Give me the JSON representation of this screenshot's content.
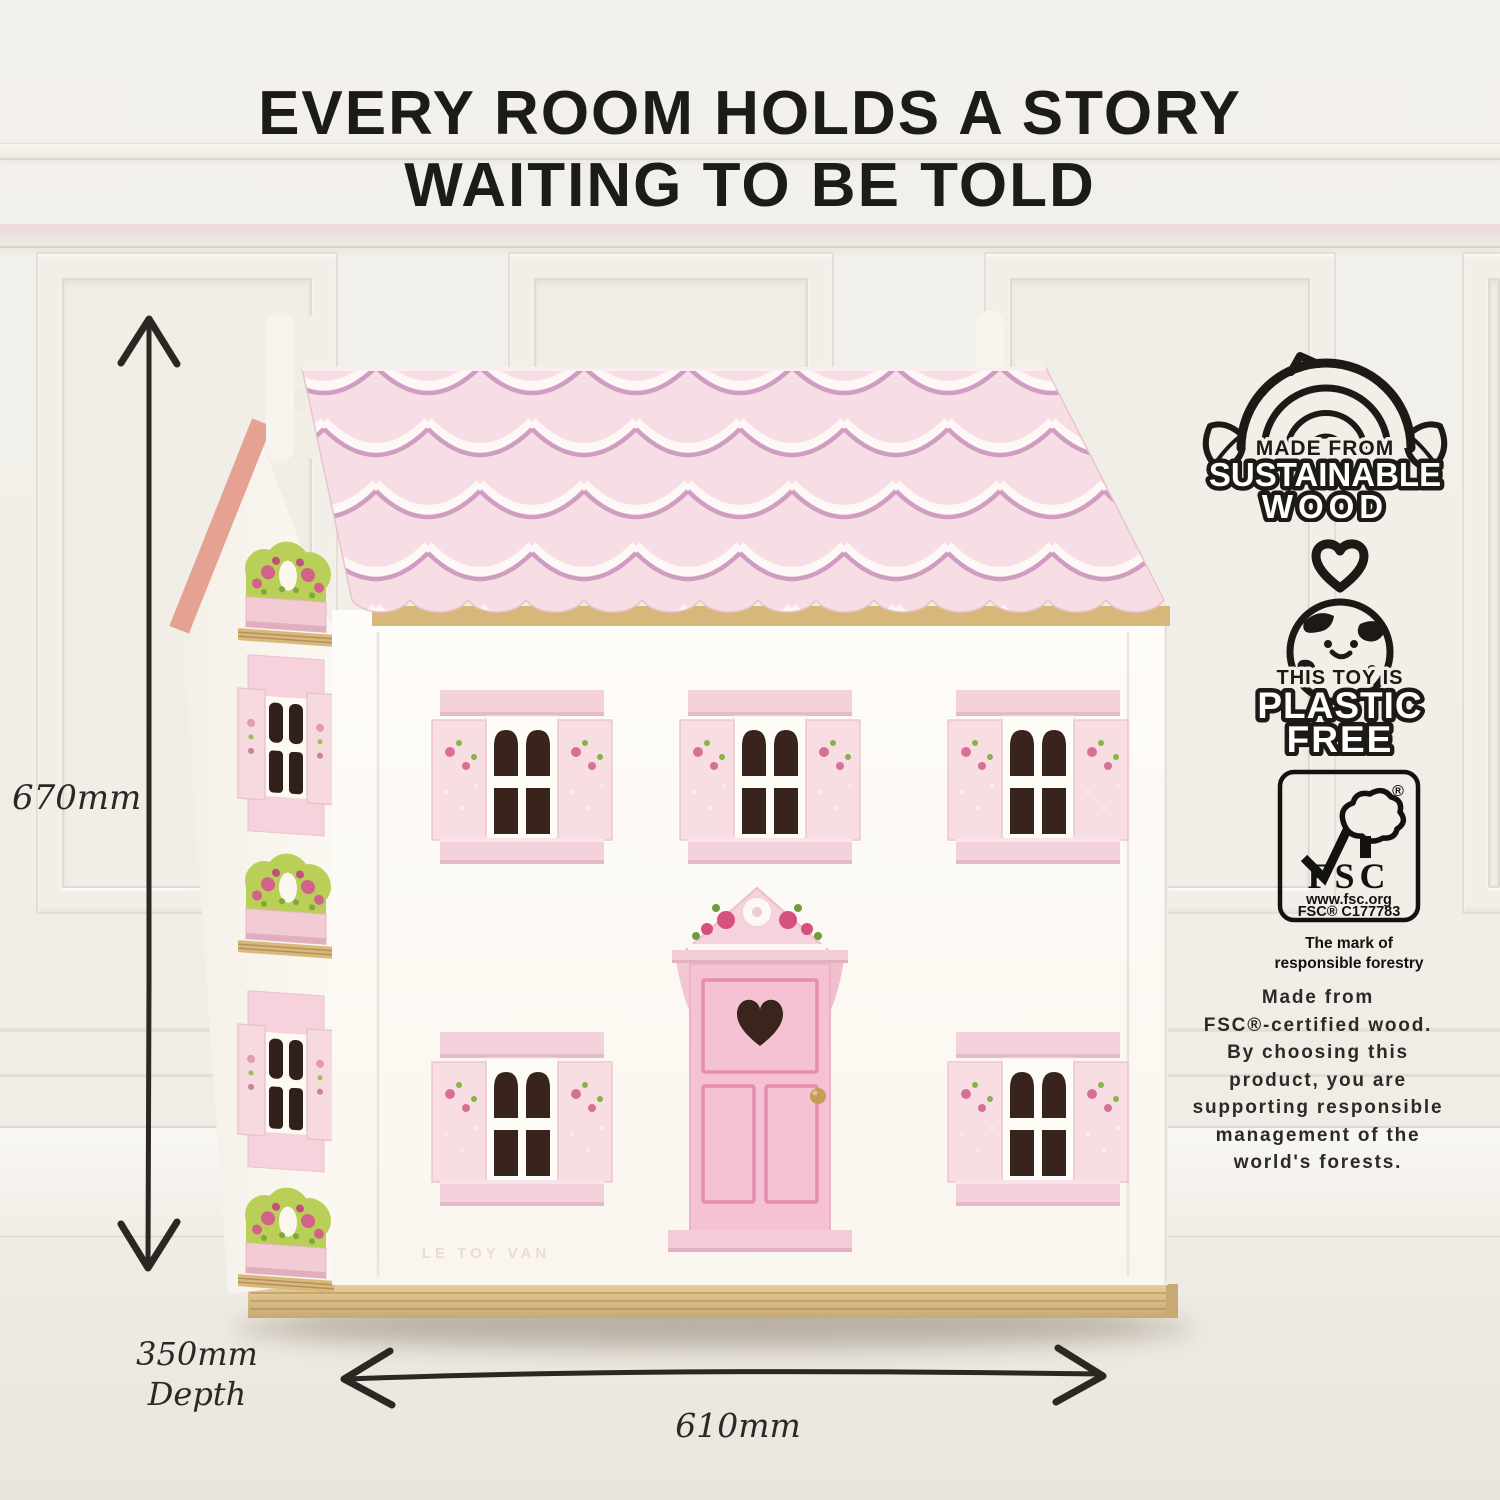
{
  "headline": {
    "line1": "EVERY ROOM HOLDS A STORY",
    "line2": "WAITING TO BE TOLD"
  },
  "dimensions": {
    "height": "670mm",
    "depth_value": "350mm",
    "depth_word": "Depth",
    "width": "610mm"
  },
  "badges": {
    "sustainable_wood": {
      "top": "MADE FROM",
      "middle": "SUSTAINABLE",
      "bottom": "WOOD"
    },
    "plastic_free": {
      "top": "THIS TOY IS",
      "middle": "PLASTIC",
      "bottom": "FREE"
    },
    "fsc": {
      "name": "FSC",
      "registered": "®",
      "url": "www.fsc.org",
      "license": "FSC® C177783",
      "caption1": "The mark of",
      "caption2": "responsible forestry"
    }
  },
  "description": {
    "lines": [
      "Made from",
      "FSC®-certified wood.",
      "By choosing this",
      "product, you are",
      "supporting responsible",
      "management of the",
      "world's forests."
    ]
  },
  "product": {
    "brand": "LE TOY VAN"
  },
  "colors": {
    "background": "#f1eee8",
    "headline_text": "#1b1b1a",
    "roof_pink": "#f7dde4",
    "roof_scallop_white": "#fdf7f5",
    "roof_scallop_mauve": "#cf9dc2",
    "gable_trim": "#e5a292",
    "house_white": "#fdfbf6",
    "shutter_pink": "#f8dde3",
    "lintel_pink": "#f3d2dc",
    "door_pink": "#f5c2d4",
    "door_trim": "#e58cb1",
    "pane_dark": "#38231d",
    "foliage_green": "#b9cf58",
    "rose_pink": "#d76f97",
    "wood_base": "#dcc08a",
    "badge_ink": "#1d1a16",
    "dimension_ink": "#2b2925"
  }
}
